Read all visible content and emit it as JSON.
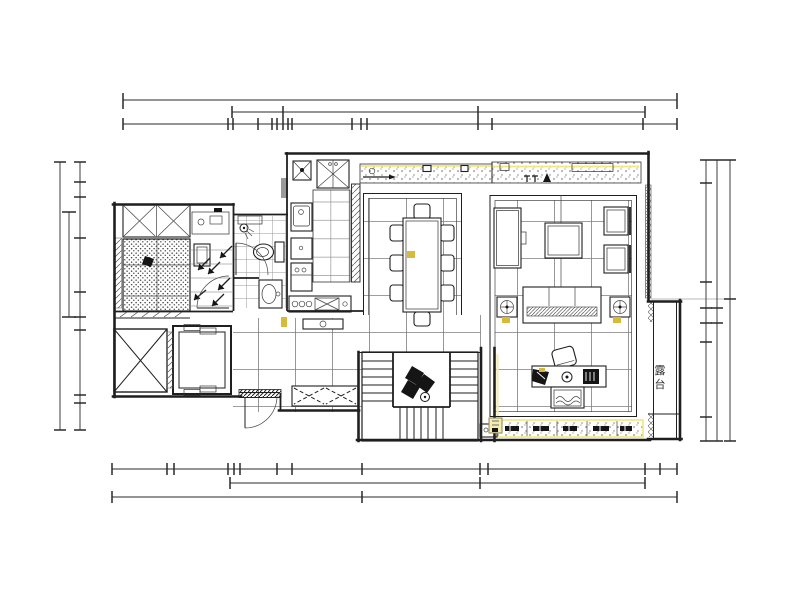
{
  "drawing": {
    "type": "residential floor plan (CAD)",
    "terrace_label": "露台",
    "colors": {
      "background": "#ffffff",
      "line": "#1f1f1f",
      "grid_line": "#7d7d7d",
      "accent_yellow": "#efe87c",
      "marker_yellow": "#d8ba3a",
      "pale_yellow": "#f3edb4"
    }
  }
}
